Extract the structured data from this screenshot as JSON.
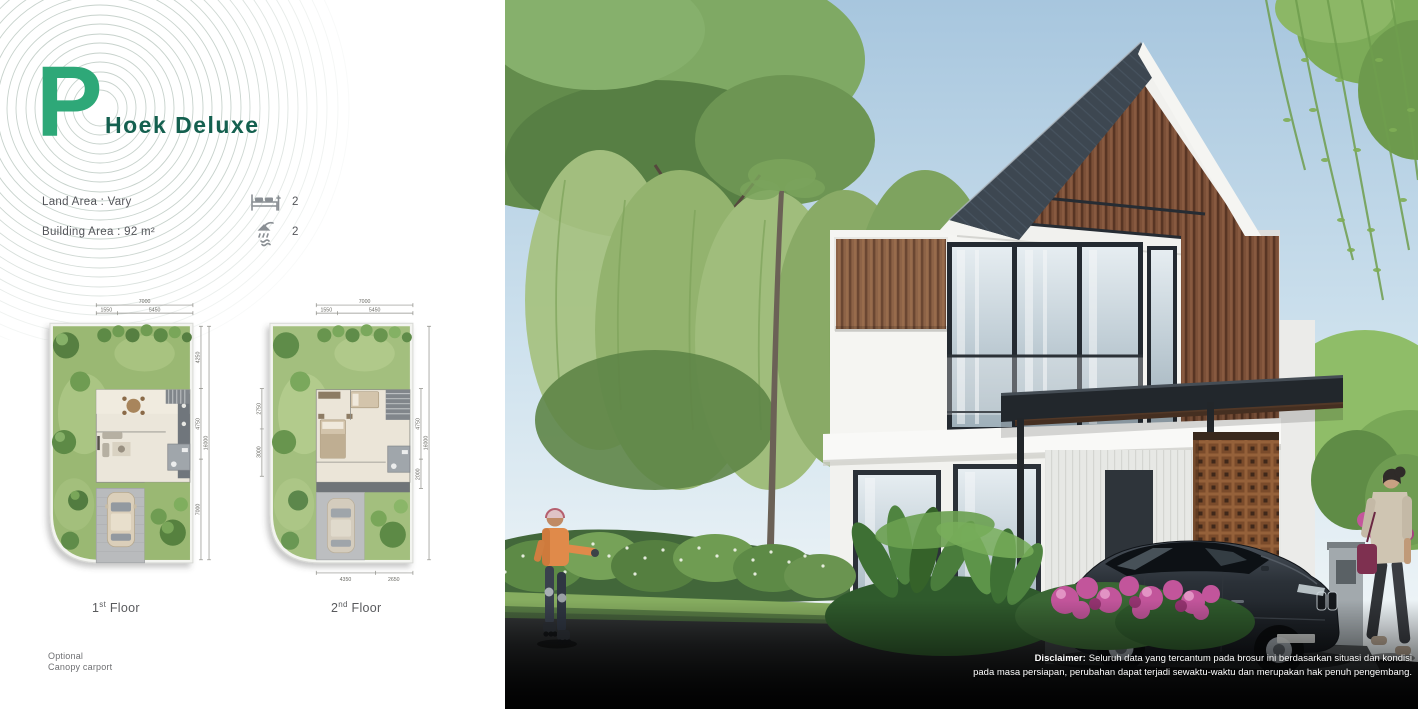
{
  "brand": {
    "letter": "P",
    "title": "Hoek Deluxe"
  },
  "specs": {
    "land_area": "Land Area : Vary",
    "building_area": "Building Area : 92 m²",
    "bedrooms": "2",
    "bathrooms": "2"
  },
  "plans": [
    {
      "cap_num": "1",
      "cap_sup": "st",
      "cap_rest": " Floor",
      "dims": {
        "top_total": "7000",
        "top_a": "1550",
        "top_b": "5450",
        "right_a": "4250",
        "right_b": "4750",
        "right_c": "7000",
        "right_total": "16000"
      }
    },
    {
      "cap_num": "2",
      "cap_sup": "nd",
      "cap_rest": " Floor",
      "dims": {
        "top_total": "7000",
        "top_a": "1550",
        "top_b": "5450",
        "right_a": "4750",
        "right_b": "2000",
        "right_total": "16000",
        "left_a": "2750",
        "left_b": "3000",
        "bottom_a": "4350",
        "bottom_b": "2650"
      }
    }
  ],
  "footnote": {
    "line1": "Optional",
    "line2": "Canopy carport"
  },
  "disclaimer": {
    "prefix": "Disclaimer:",
    "line1": "Seluruh data yang tercantum pada brosur ini berdasarkan situasi dan kondisi",
    "line2": "pada masa persiapan, perubahan dapat terjadi sewaktu-waktu dan merupakan hak penuh pengembang."
  },
  "colors": {
    "accent_green": "#2EA878",
    "title_teal": "#14604F",
    "roof_slate": "#3D4751",
    "wood_brown": "#8A6046",
    "flower_pink": "#C2559B"
  }
}
